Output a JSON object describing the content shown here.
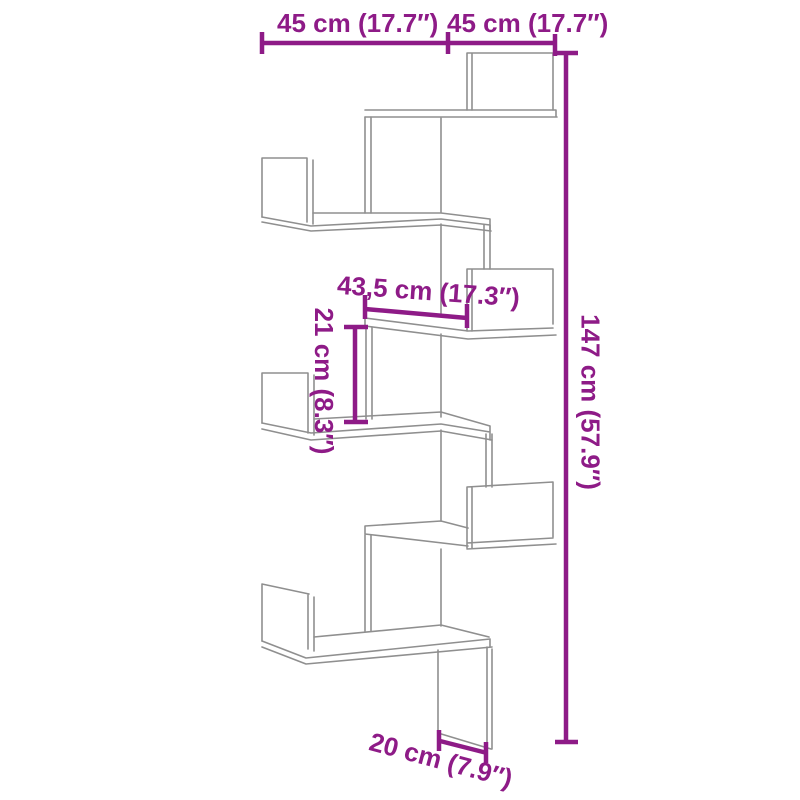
{
  "figure": {
    "colors": {
      "dimension_accent": "#8e1b87",
      "line_art_gray": "#8f8f8f",
      "background": "#ffffff"
    },
    "labels": {
      "width_left": "45 cm (17.7″)",
      "width_right": "45 cm (17.7″)",
      "height": "147 cm (57.9″)",
      "middle_width": "43,5 cm (17.3″)",
      "gap_height": "21 cm (8.3″)",
      "depth": "20 cm (7.9″)"
    }
  }
}
